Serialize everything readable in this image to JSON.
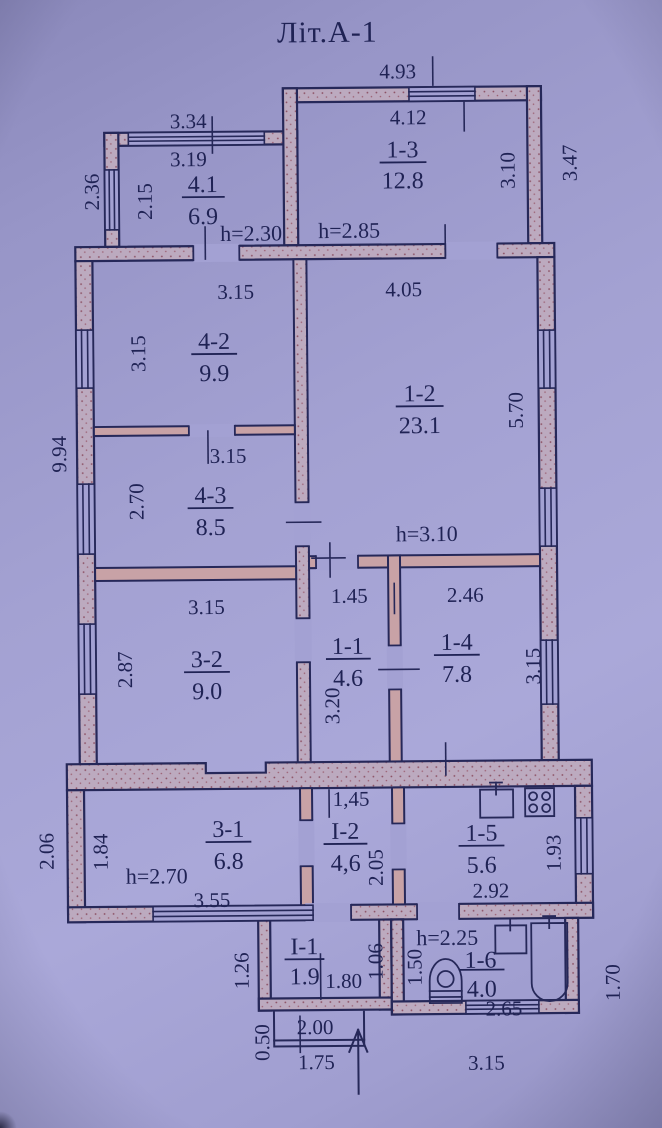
{
  "title": "Літ.А-1",
  "colors": {
    "paper": "#a3a1d3",
    "ink": "#262859",
    "wall_fill": "#bcaabf",
    "wall_speckle": "#8a4f62",
    "partition_fill": "#c8a2a6"
  },
  "rooms": {
    "r41": {
      "num": "4.1",
      "area": "6.9",
      "height": "h=2.30"
    },
    "r13": {
      "num": "1-3",
      "area": "12.8",
      "height": "h=2.85"
    },
    "r42": {
      "num": "4-2",
      "area": "9.9"
    },
    "r12": {
      "num": "1-2",
      "area": "23.1",
      "height": "h=3.10"
    },
    "r43": {
      "num": "4-3",
      "area": "8.5"
    },
    "r32": {
      "num": "3-2",
      "area": "9.0"
    },
    "r11": {
      "num": "1-1",
      "area": "4.6"
    },
    "r14": {
      "num": "1-4",
      "area": "7.8"
    },
    "r31": {
      "num": "3-1",
      "area": "6.8",
      "height": "h=2.70"
    },
    "rI2": {
      "num": "I-2",
      "area": "4,6"
    },
    "r15": {
      "num": "1-5",
      "area": "5.6"
    },
    "rI1": {
      "num": "I-1",
      "area": "1.9"
    },
    "r16": {
      "num": "1-6",
      "area": "4.0",
      "height": "h=2.25"
    }
  },
  "dims": {
    "outer_top": "4.93",
    "r13_top": "4.12",
    "r13_right": "3.10",
    "annex13_right_out": "3.47",
    "annex41_top_out": "3.34",
    "annex41_top_in": "3.19",
    "annex41_left_out": "2.36",
    "annex41_left_in": "2.15",
    "main_left_out": "9.94",
    "r42_top": "3.15",
    "r42_left": "3.15",
    "r12_top": "4.05",
    "r12_right": "5.70",
    "r43_top": "3.15",
    "r43_left": "2.70",
    "r32_top": "3.15",
    "r32_left": "2.87",
    "r11_top": "1.45",
    "r11_left": "3.20",
    "r14_top": "2.46",
    "r14_right": "3.15",
    "band_left_out": "2.06",
    "band_left_in": "1.84",
    "r31_bottom": "3.55",
    "rI2_top": "1,45",
    "rI2_right": "2.05",
    "r15_bottom": "2.92",
    "r15_right": "1.93",
    "annexI1_left_out": "1.26",
    "annexI1_width": "1.80",
    "annexI1_right": "1.06",
    "porch_left": "0.50",
    "porch_width": "2.00",
    "porch_bottom": "1.75",
    "r16_left": "1.50",
    "r16_bottom_in": "2.65",
    "annex16_right_out": "1.70",
    "annex16_bottom_out": "3.15"
  },
  "fixtures": {
    "kitchen_sink": "sink-with-tap",
    "kitchen_stove": "four-burner-stove",
    "toilet": "toilet-top-view",
    "washbasin": "washbasin-with-tap",
    "bathtub": "bathtub-top-view",
    "entrance": "entrance-arrow"
  }
}
